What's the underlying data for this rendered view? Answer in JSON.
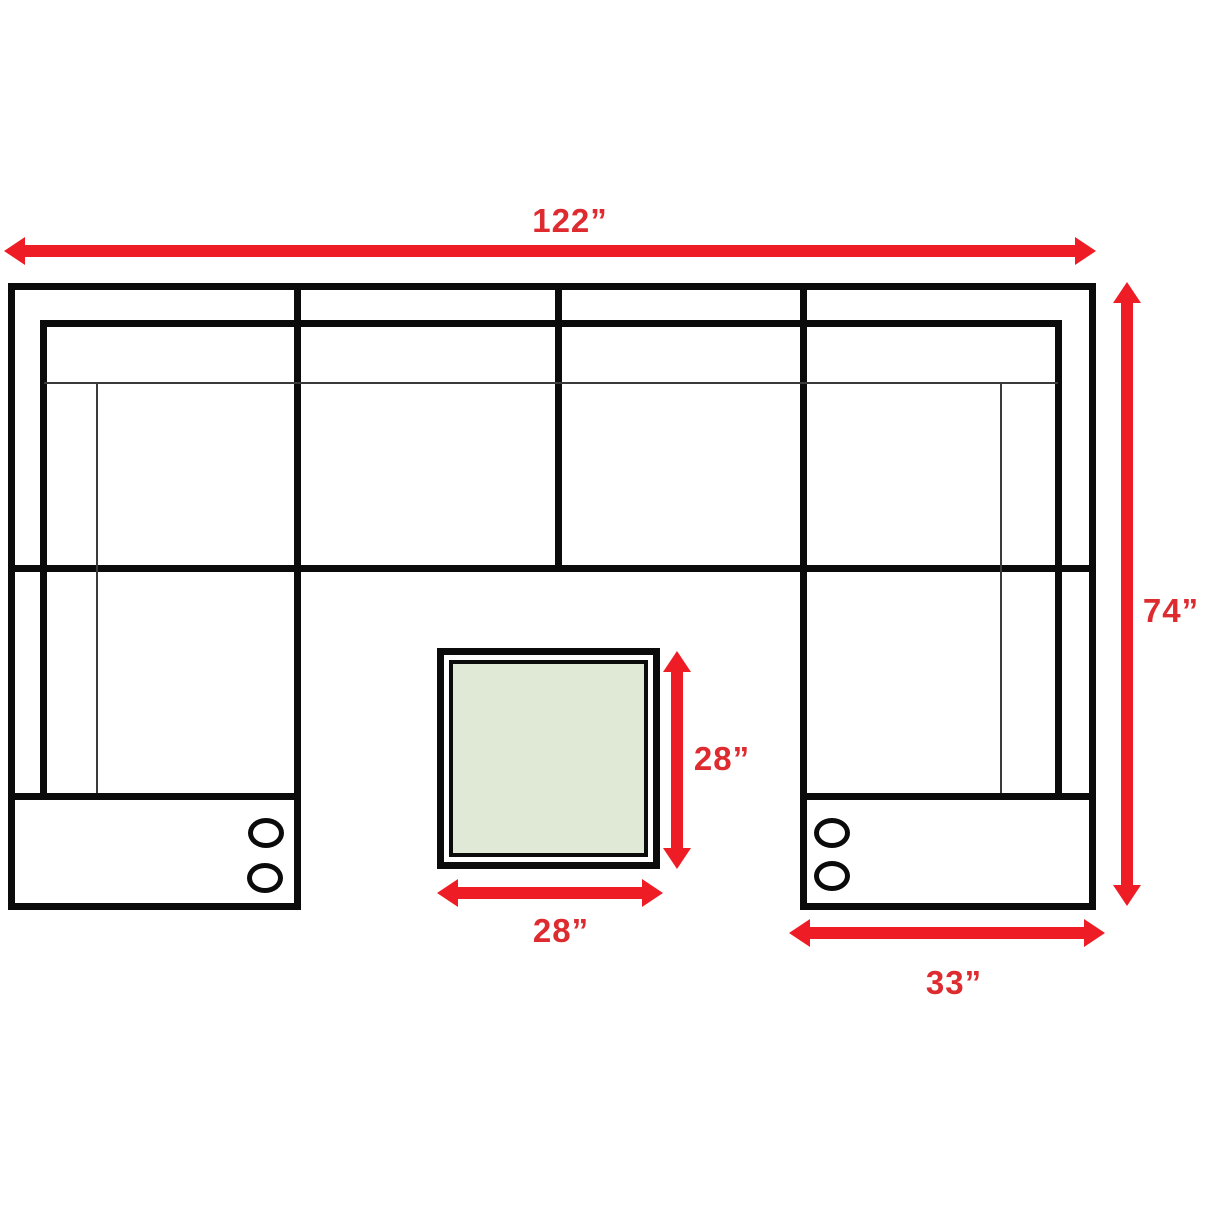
{
  "diagram": {
    "kind": "sectional-sofa-with-ottoman-floorplan",
    "labels": {
      "overall_width": "122”",
      "overall_depth": "74”",
      "ottoman_depth": "28”",
      "ottoman_width": "28”",
      "console_width": "33”"
    },
    "colors": {
      "arrow_red": "#ee1c24",
      "label_red": "#dd2b30",
      "outline_black": "#0b0b0b",
      "ottoman_fill_green": "#dfe9d5",
      "background": "#ffffff"
    }
  }
}
